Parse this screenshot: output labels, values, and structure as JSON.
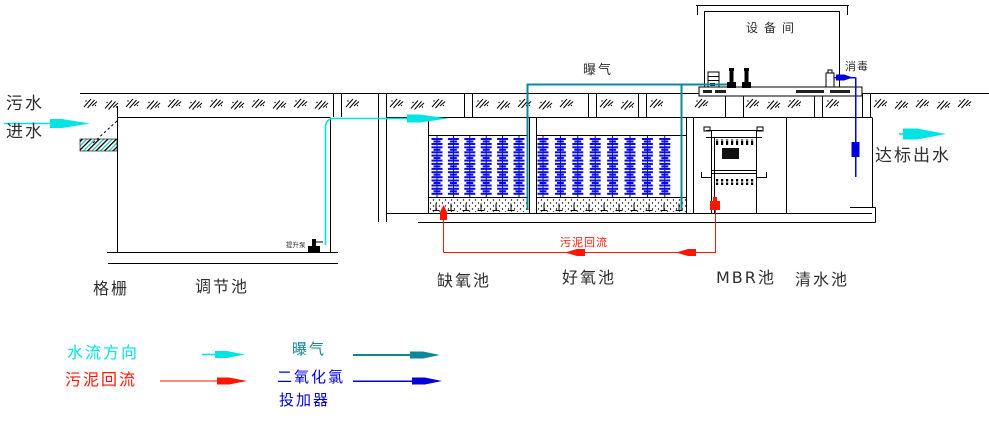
{
  "labels": {
    "inflow_line1": "污水",
    "inflow_line2": "进水",
    "screen": "格栅",
    "regulating_tank": "调节池",
    "lift_pump": "提升泵",
    "anoxic_tank": "缺氧池",
    "aerobic_tank": "好氧池",
    "mbr_tank": "MBR池",
    "clear_tank": "清水池",
    "equipment_room": "设备间",
    "aeration": "曝气",
    "disinfection": "消毒",
    "sludge_return": "污泥回流",
    "effluent": "达标出水"
  },
  "legend": {
    "water_flow": "水流方向",
    "sludge_return": "污泥回流",
    "aeration": "曝气",
    "clo2_line1": "二氧化氯",
    "clo2_line2": "投加器"
  },
  "colors": {
    "water": "#00e4e4",
    "sludge": "#ff1500",
    "aeration": "#0d8899",
    "chlorine": "#0000dd",
    "media": "#0a0af0",
    "text": "#2f2f2f"
  },
  "media": {
    "anoxic_columns": 6,
    "aerobic_columns": 8,
    "clusters_per_column": 7
  }
}
